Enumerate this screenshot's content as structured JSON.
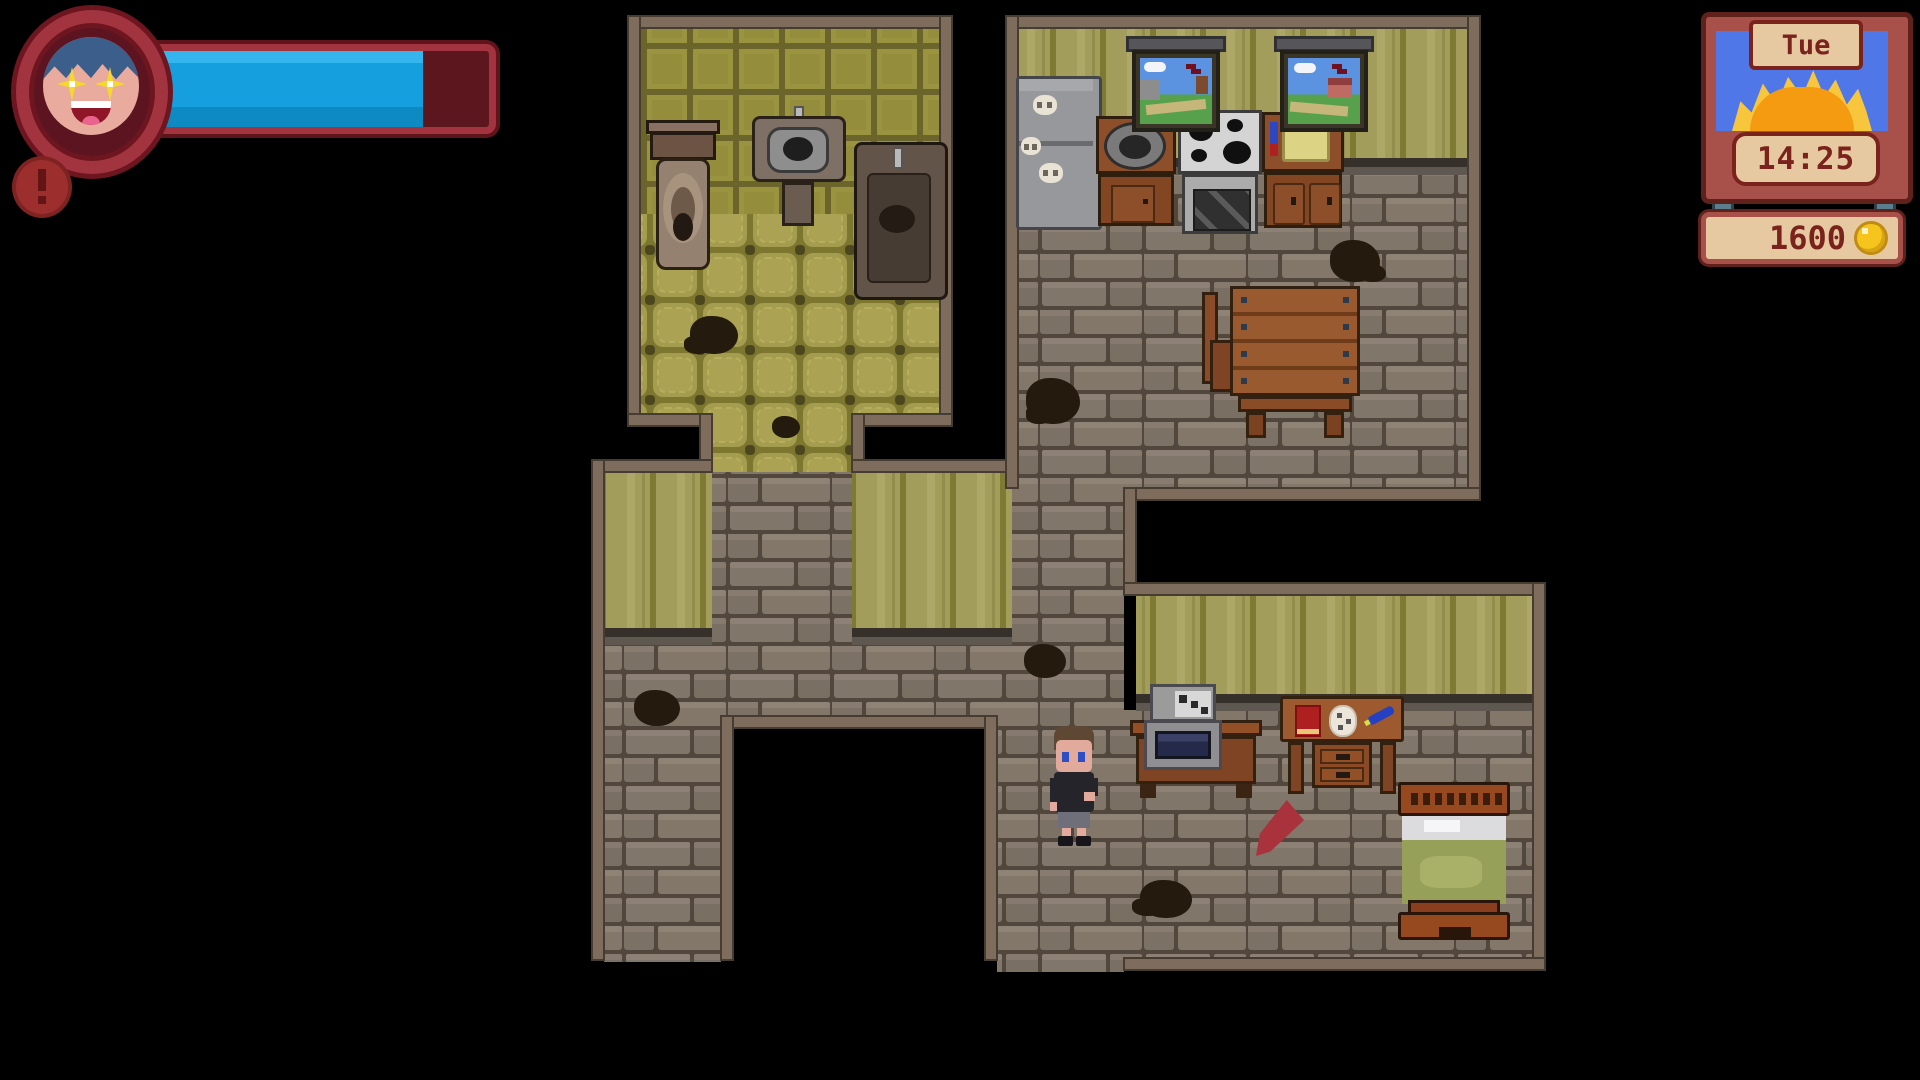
{
  "hud": {
    "avatar": {
      "icon": "player-portrait",
      "expression": "starry-eyes-smile",
      "frame_color": "#a23440"
    },
    "energy_bar": {
      "fill_percent": 82,
      "fill_color": "#169fde",
      "empty_color": "#5c171e",
      "border_color": "#a23440"
    },
    "notification": {
      "icon": "exclamation-icon",
      "color": "#9c2e2e"
    },
    "clock": {
      "day": "Tue",
      "time": "14:25",
      "weather_icon": "rising-sun-icon",
      "sky_color": "#5077e8",
      "frame_color": "#a8504a",
      "panel_color": "#e6c9a1",
      "text_color": "#7a231c"
    },
    "wallet": {
      "amount": "1600",
      "coin_icon": "coin-icon",
      "coin_color": "#f5c41d"
    }
  },
  "scene": {
    "rooms": [
      {
        "name": "bathroom",
        "objects": [
          "toilet",
          "sink",
          "bathtub"
        ]
      },
      {
        "name": "kitchen",
        "objects": [
          "fridge",
          "counter-with-pot",
          "stove-oven",
          "cabinet-with-cutting-board",
          "window",
          "window",
          "dining-table",
          "chair",
          "chair"
        ]
      },
      {
        "name": "hallway",
        "objects": []
      },
      {
        "name": "bedroom",
        "objects": [
          "tv",
          "tv-stand",
          "desk",
          "bed",
          "quest-marker-arrow"
        ]
      }
    ],
    "player": {
      "label": "player-character",
      "location": "bedroom"
    }
  }
}
